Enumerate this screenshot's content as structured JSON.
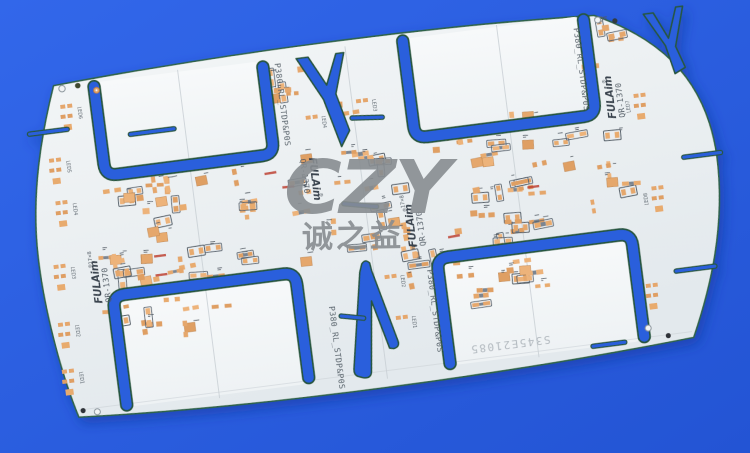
{
  "watermark": {
    "brand_large": "CZY",
    "brand_chinese": "诚之益"
  },
  "board": {
    "silkscreen": {
      "brand": "FULAim",
      "registered": "®",
      "model": "QR-1370",
      "panel_code": "P380_RL_STDP&P0S",
      "matrix": "17×8",
      "serial_etched": "S345E21085"
    },
    "edge_labels_left": [
      "LED6",
      "LED5",
      "LED4",
      "LED3",
      "LED2",
      "LED1"
    ],
    "edge_labels_right": [
      "LED7",
      "LED8",
      "LED6"
    ],
    "interior_labels": [
      "LED4",
      "LED3",
      "LED2",
      "LED1"
    ],
    "colors": {
      "background_blue": "#2c5fe0",
      "slot_blue": "#2b5edc",
      "board_white": "#eef2f4",
      "panel_blank_white": "#f5f7f8",
      "pad_copper": "#e2a46a",
      "slot_rim_green": "#27563f",
      "silkscreen_dark": "#49545e",
      "watermark_gray": "#888d91",
      "red_mark": "#bf4133"
    }
  }
}
